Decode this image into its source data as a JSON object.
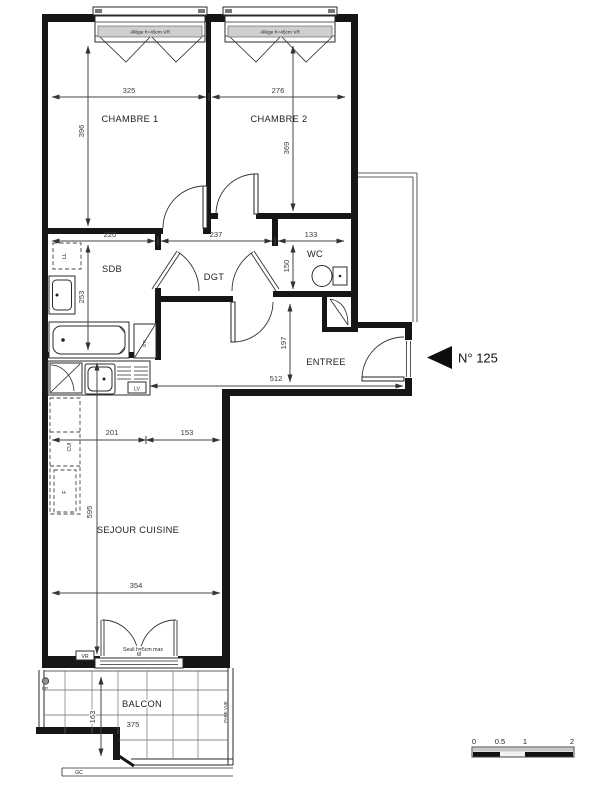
{
  "plan": {
    "unit": {
      "number": "N° 125"
    },
    "rooms": {
      "chambre1": {
        "label": "CHAMBRE 1",
        "width": "325",
        "height": "396"
      },
      "chambre2": {
        "label": "CHAMBRE 2",
        "width": "276",
        "height": "369"
      },
      "sdb": {
        "label": "SDB",
        "width": "220",
        "height": "253"
      },
      "dgt": {
        "label": "DGT",
        "width": "237"
      },
      "wc": {
        "label": "WC",
        "width": "133",
        "height": "150"
      },
      "entree": {
        "label": "ENTREE",
        "width": "512",
        "height": "197"
      },
      "sejour": {
        "label": "SEJOUR CUISINE",
        "width": "354",
        "height": "595",
        "kitchen_zone": "201",
        "dining_zone": "153"
      },
      "balcon": {
        "label": "BALCON",
        "width": "375",
        "height": "163"
      }
    },
    "fixtures": {
      "washing_machine": "LL",
      "dishwasher": "LV",
      "kitchen_units": "CUI",
      "fridge": "F",
      "duct": "GTL",
      "rainwater_pipe": "EP",
      "gutter": "GC",
      "shutter": "VR",
      "privacy_screen": "PARE VUE"
    },
    "notes": {
      "window_sill": "Allège h=45cm VR",
      "threshold": "Seuil h=5cm max"
    },
    "scale_bar": {
      "labels": [
        "0",
        "0.5",
        "1",
        "2"
      ]
    }
  }
}
